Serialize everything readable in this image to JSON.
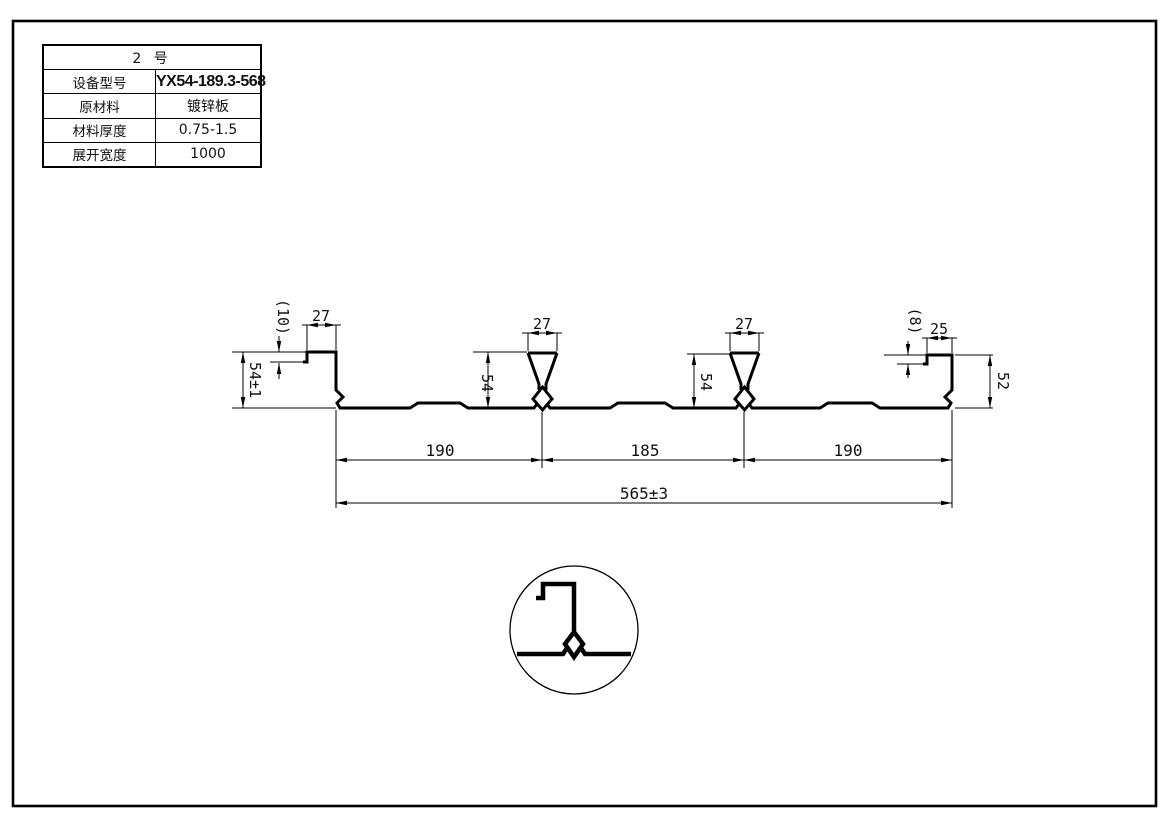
{
  "sheet": {
    "background": "#ffffff",
    "line_color": "#000000"
  },
  "table": {
    "title": "2 号",
    "rows": [
      {
        "label": "设备型号",
        "value": "YX54-189.3-568"
      },
      {
        "label": "原材料",
        "value": "镀锌板"
      },
      {
        "label": "材料厚度",
        "value": "0.75-1.5"
      },
      {
        "label": "展开宽度",
        "value": "1000"
      }
    ]
  },
  "dims": {
    "left_step": "(10)",
    "left_lip_width": "27",
    "left_height": "54±1",
    "rib1_width": "27",
    "rib1_height": "54",
    "rib2_width": "27",
    "rib2_height": "54",
    "right_step": "(8)",
    "right_lip_width": "25",
    "right_height": "52",
    "pitch_left": "190",
    "pitch_mid": "185",
    "pitch_right": "190",
    "overall_width": "565±3"
  }
}
